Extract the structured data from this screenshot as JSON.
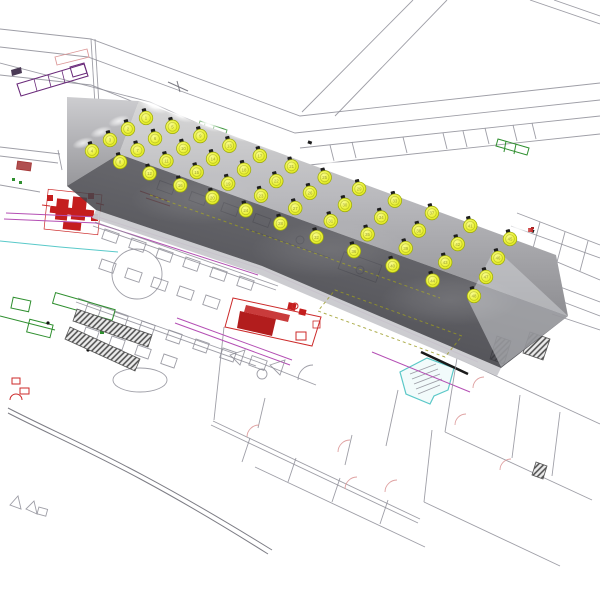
{
  "scene": {
    "background": "#ffffff",
    "viewport_width": 600,
    "viewport_height": 600
  },
  "room": {
    "floor_color": "#3c3c42",
    "wall_top_color": "#d8d8d8",
    "wall_bottom_color": "#8e8e92",
    "lit_wedge_color": "#cfd2d6",
    "glow_color": "#ffffff"
  },
  "luminaires": {
    "count": 48,
    "rows": 4,
    "cols": 12,
    "fill": "#ecf23c",
    "fill_light": "#f8fb8e",
    "fill_dark": "#dce41a",
    "stroke": "#9aa80a",
    "cap_color": "#1e1e1e",
    "label_color": "rgba(80,85,10,0.55)",
    "labels": [
      1,
      2,
      3,
      4,
      5,
      6,
      7,
      8,
      9,
      10,
      11,
      12,
      13,
      14,
      15,
      16,
      17,
      18,
      19,
      20,
      21,
      22,
      23,
      24,
      25,
      26,
      27,
      28,
      29,
      30,
      31,
      32,
      33,
      34,
      35,
      36,
      37,
      38,
      39,
      40,
      41,
      42,
      43,
      44,
      45,
      46,
      47,
      48
    ],
    "grid": {
      "start": [
        146,
        118
      ],
      "span": [
        364,
        121
      ],
      "ease_a": 0.78,
      "ease_b": 0.22,
      "row_step_left": [
        -18,
        11
      ],
      "row_step_right": [
        -12,
        19
      ]
    }
  },
  "plan": {
    "line_color": "#8d8d96",
    "accent_red": "#cc2a2a",
    "accent_green": "#2f8f2f",
    "accent_magenta": "#b44fb4",
    "accent_cyan": "#59c9c9",
    "accent_purple": "#6a2a7a",
    "accent_pink": "#dc9898",
    "dash_olive": "#9a9a22"
  }
}
